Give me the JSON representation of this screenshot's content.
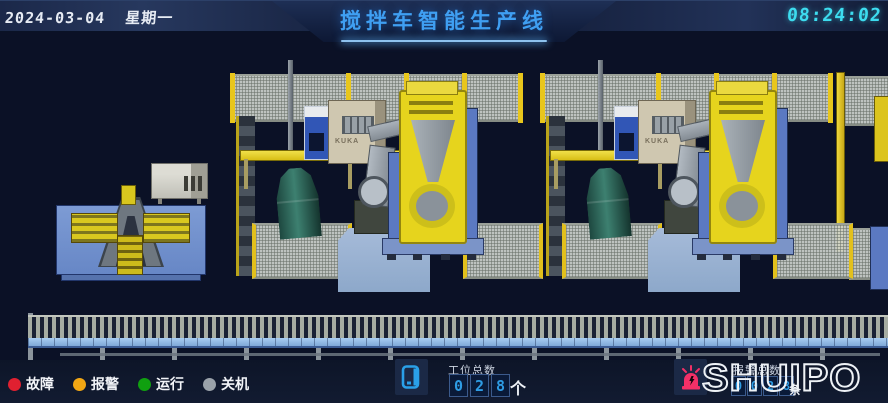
{
  "header": {
    "date": "2024-03-04",
    "weekday": "星期一",
    "title": "搅拌车智能生产线",
    "time": "08:24:02"
  },
  "scene": {
    "equipment_brand": "KUKA"
  },
  "legend": {
    "items": [
      {
        "label": "故障",
        "color": "#e02030",
        "icon": "red-status-dot"
      },
      {
        "label": "报警",
        "color": "#f2a714",
        "icon": "orange-status-dot"
      },
      {
        "label": "运行",
        "color": "#10a010",
        "icon": "green-status-dot"
      },
      {
        "label": "关机",
        "color": "#9aa2aa",
        "icon": "gray-status-dot"
      }
    ]
  },
  "counters": {
    "stations": {
      "icon": "hmi-panel-icon",
      "label": "工位总数",
      "digits": [
        "0",
        "2",
        "8"
      ],
      "unit": "个"
    },
    "alarms": {
      "icon": "alarm-beacon-icon",
      "label": "报警总数",
      "digits": [
        "0",
        "0",
        "2",
        "8"
      ],
      "unit": "条"
    }
  },
  "brand": {
    "logo_text": "SHUIPO"
  },
  "colors": {
    "accent_blue": "#3f9ff2",
    "time_cyan": "#3ddcef",
    "digit_blue": "#2e9ce4",
    "beacon_pink": "#f23067"
  }
}
